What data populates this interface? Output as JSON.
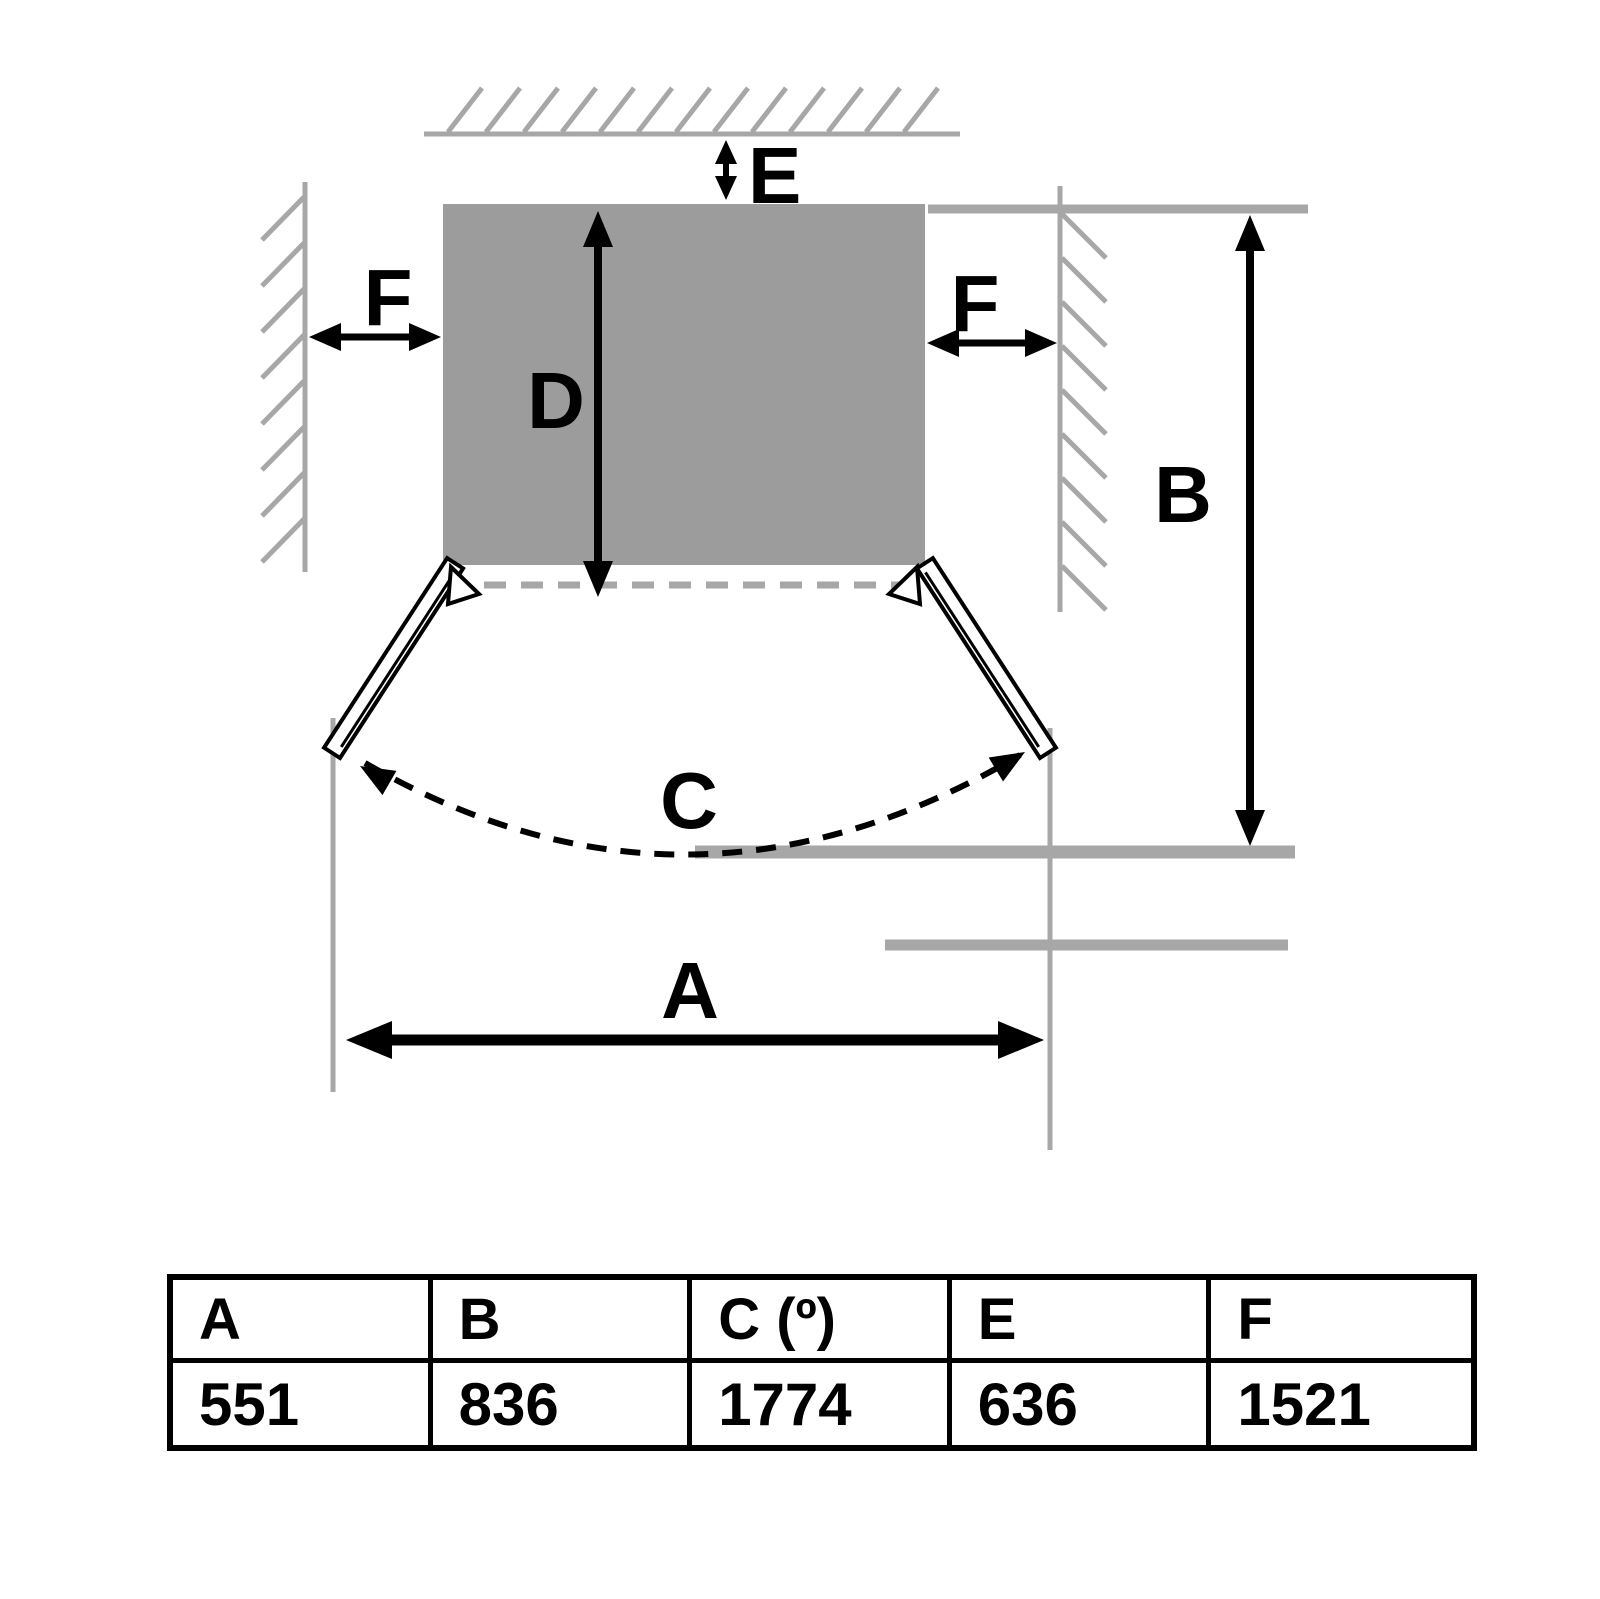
{
  "diagram": {
    "labels": {
      "a": "A",
      "b": "B",
      "c": "C",
      "d": "D",
      "e": "E",
      "f_left": "F",
      "f_right": "F"
    },
    "colors": {
      "appliance_fill": "#9c9c9c",
      "wall_line": "#a7a7a7",
      "dimension_black": "#000000",
      "door_fill": "#ffffff"
    }
  },
  "table": {
    "headers": [
      "A",
      "B",
      "C (º)",
      "E",
      "F"
    ],
    "values": [
      "551",
      "836",
      "1774",
      "636",
      "1521"
    ]
  }
}
